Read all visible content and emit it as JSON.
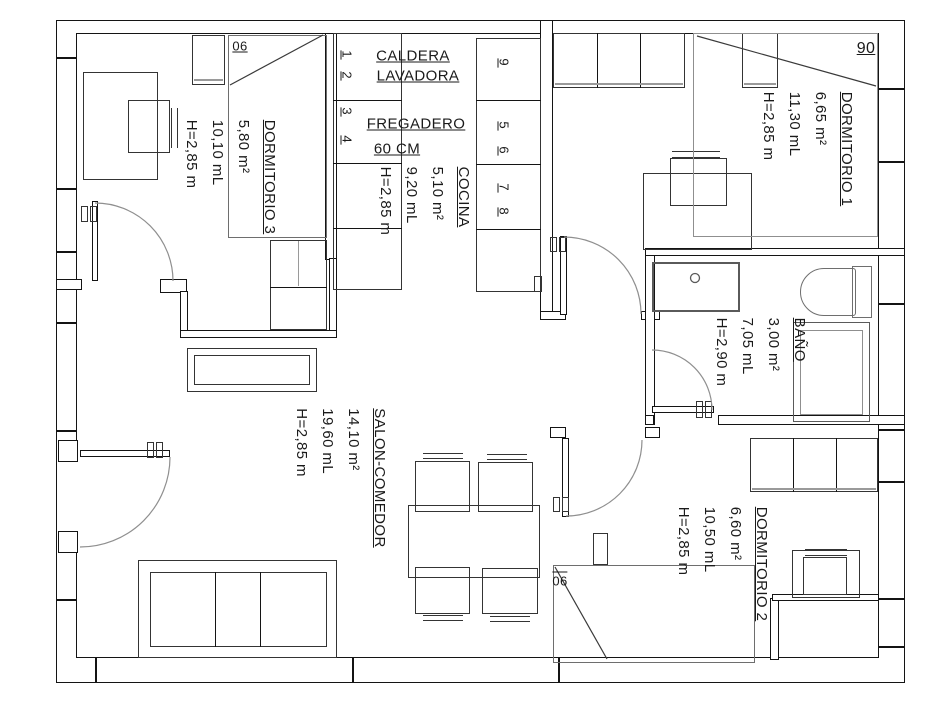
{
  "rooms": {
    "dormitorio3": {
      "name": "DORMITORIO 3",
      "area": "5,80 m²",
      "perimeter": "10,10 mL",
      "height": "H=2,85 m",
      "bed_width": "06"
    },
    "cocina": {
      "name": "COCINA",
      "area": "5,10 m²",
      "perimeter": "9,20 mL",
      "height": "H=2,85 m"
    },
    "dormitorio1": {
      "name": "DORMITORIO 1",
      "area": "6,65 m²",
      "perimeter": "11,30 mL",
      "height": "H=2,85 m",
      "bed_width": "90"
    },
    "bano": {
      "name": "BAÑO",
      "area": "3,00 m²",
      "perimeter": "7,05 mL",
      "height": "H=2,90 m"
    },
    "salon": {
      "name": "SALON-COMEDOR",
      "area": "14,10 m²",
      "perimeter": "19,60 mL",
      "height": "H=2,85 m"
    },
    "dormitorio2": {
      "name": "DORMITORIO 2",
      "area": "6,60 m²",
      "perimeter": "10,50 mL",
      "height": "H=2,85 m",
      "bed_width": "06"
    }
  },
  "kitchen": {
    "caldera": "CALDERA",
    "lavadora": "LAVADORA",
    "fregadero": "FREGADERO",
    "size_note": "60 CM",
    "cabinet_numbers": {
      "n1": "1",
      "n2": "2",
      "n3": "3",
      "n4": "4",
      "n5": "5",
      "n6": "6",
      "n7": "7",
      "n8": "8",
      "n9": "9"
    }
  },
  "colors": {
    "line": "#141414",
    "furniture": "#343434",
    "fixture": "#5a5a5a",
    "muted": "#9a9a9a",
    "background": "#ffffff"
  }
}
